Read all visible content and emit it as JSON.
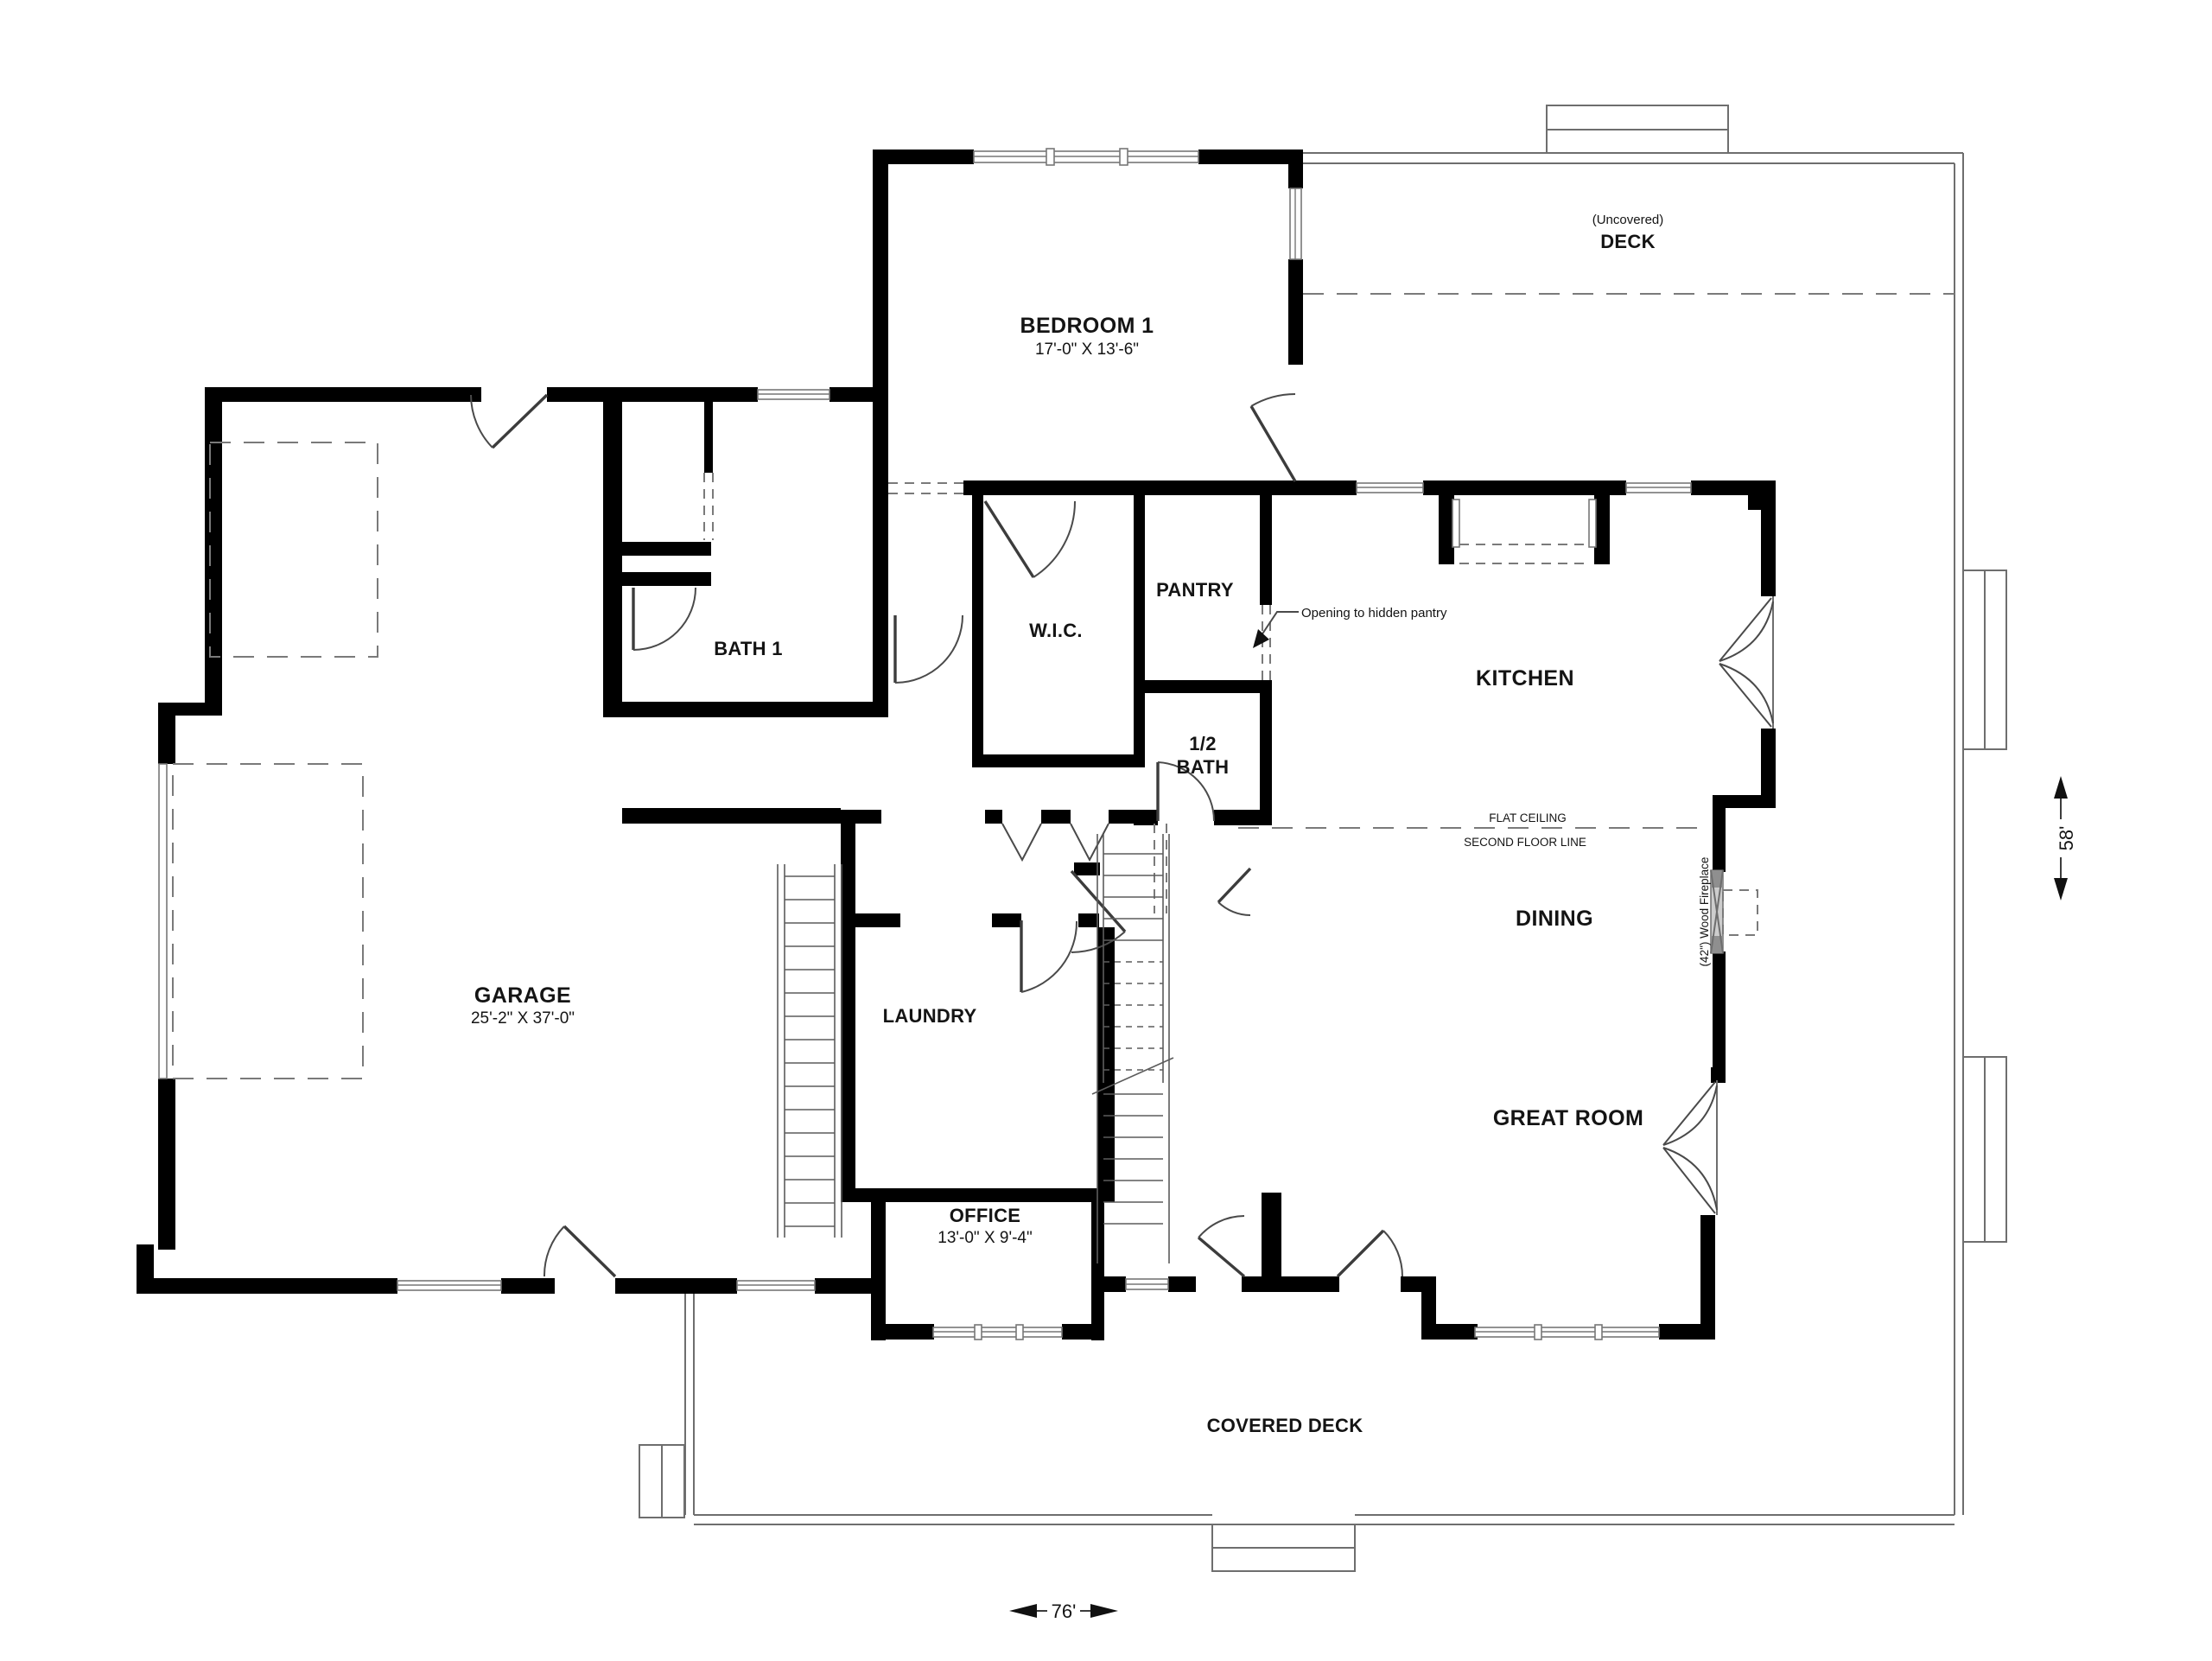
{
  "rooms": {
    "bedroom1": {
      "label": "BEDROOM 1",
      "dims": "17'-0\" X 13'-6\""
    },
    "garage": {
      "label": "GARAGE",
      "dims": "25'-2\" X 37'-0\""
    },
    "office": {
      "label": "OFFICE",
      "dims": "13'-0\" X 9'-4\""
    },
    "bath1": {
      "label": "BATH 1"
    },
    "wic": {
      "label": "W.I.C."
    },
    "pantry": {
      "label": "PANTRY"
    },
    "half_bath": {
      "line1": "1/2",
      "line2": "BATH"
    },
    "kitchen": {
      "label": "KITCHEN"
    },
    "dining": {
      "label": "DINING"
    },
    "great_room": {
      "label": "GREAT ROOM"
    },
    "laundry": {
      "label": "LAUNDRY"
    },
    "deck": {
      "note": "(Uncovered)",
      "label": "DECK"
    },
    "covered_deck": {
      "label": "COVERED DECK"
    }
  },
  "annotations": {
    "hidden_pantry": "Opening to hidden pantry",
    "flat_ceiling": "FLAT CEILING",
    "second_floor_line": "SECOND FLOOR LINE",
    "fireplace": "(42\") Wood Fireplace"
  },
  "dimensions": {
    "width": "76'",
    "depth": "58'"
  },
  "colors": {
    "wall": "#000000",
    "line": "#6e6e6e",
    "text": "#141414",
    "fireplace": "#c8c8c8"
  }
}
